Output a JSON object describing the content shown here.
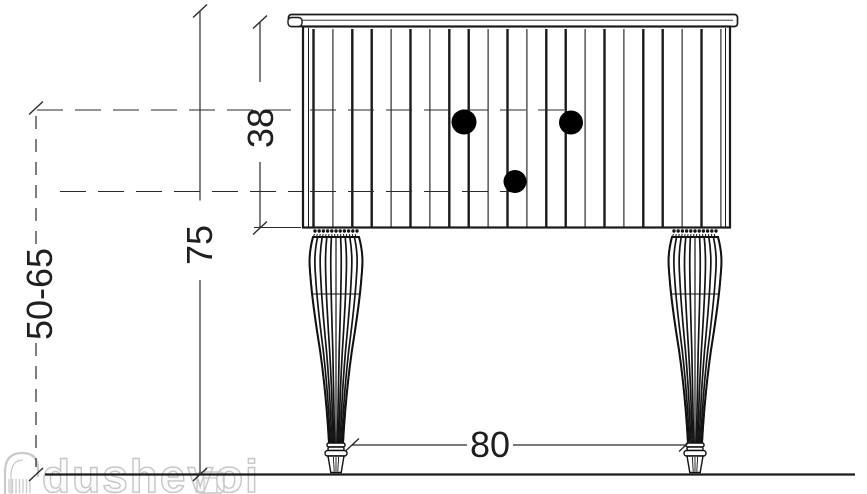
{
  "page": {
    "background": "#ffffff"
  },
  "drawing": {
    "kind": "furniture-technical-drawing-front-elevation",
    "subject": "vanity cabinet with fluted front and turned legs",
    "line_color": "#1a1a1a",
    "dimensions": {
      "overall_height": "75",
      "body_height": "38",
      "installation_height_range": "50-65",
      "width": "80"
    },
    "knobs": {
      "count": 3,
      "color": "#000000"
    },
    "watermark": {
      "text": "dushevoi",
      "color": "#c8c8c8"
    }
  }
}
